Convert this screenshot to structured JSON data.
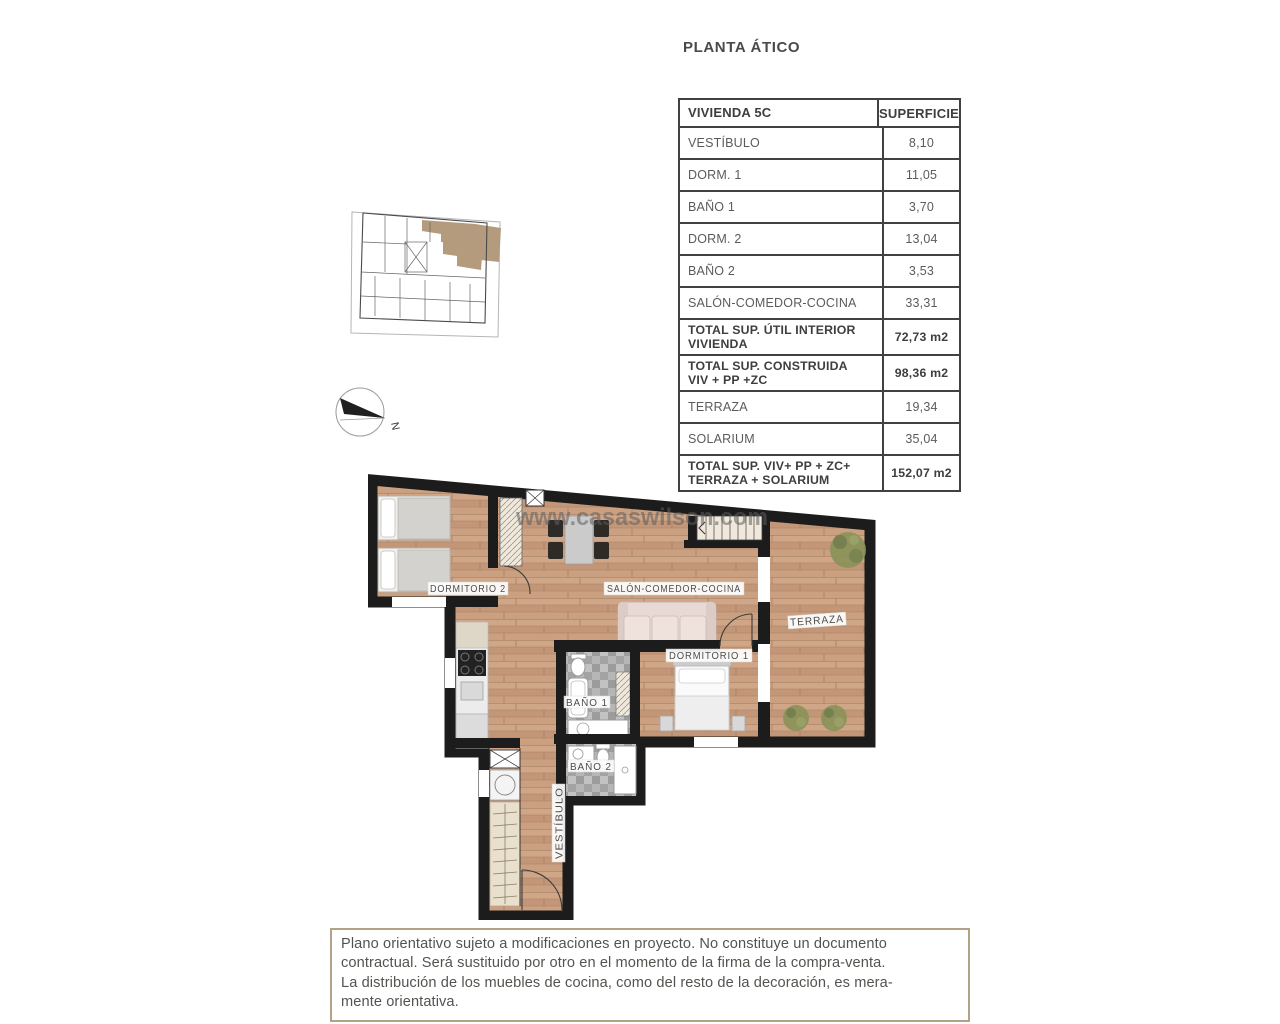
{
  "page": {
    "title": "PLANTA ÁTICO"
  },
  "area_table": {
    "header": {
      "name_col": "VIVIENDA 5C",
      "value_col": "SUPERFICIE"
    },
    "rows": [
      {
        "label": "VESTÍBULO",
        "value": "8,10"
      },
      {
        "label": "DORM. 1",
        "value": "11,05"
      },
      {
        "label": "BAÑO 1",
        "value": "3,70"
      },
      {
        "label": "DORM. 2",
        "value": "13,04"
      },
      {
        "label": "BAÑO 2",
        "value": "3,53"
      },
      {
        "label": "SALÓN-COMEDOR-COCINA",
        "value": "33,31"
      },
      {
        "label": "TOTAL SUP. ÚTIL INTERIOR\nVIVIENDA",
        "value": "72,73 m2"
      },
      {
        "label": "TOTAL SUP. CONSTRUIDA\nVIV + PP +ZC",
        "value": "98,36 m2"
      },
      {
        "label": "TERRAZA",
        "value": "19,34"
      },
      {
        "label": "SOLARIUM",
        "value": "35,04"
      },
      {
        "label": "TOTAL SUP. VIV+ PP + ZC+\nTERRAZA + SOLARIUM",
        "value": "152,07 m2"
      }
    ]
  },
  "floorplan": {
    "watermark": "www.casaswilson.com",
    "labels": {
      "dormitorio2": "DORMITORIO 2",
      "salon": "SALÓN-COMEDOR-COCINA",
      "dormitorio1": "DORMITORIO 1",
      "bano1": "BAÑO 1",
      "bano2": "BAÑO 2",
      "terraza": "TERRAZA",
      "vestibulo": "VESTÍBULO"
    }
  },
  "compass": {
    "north_label": "N"
  },
  "disclaimer": {
    "lines": [
      "Plano orientativo sujeto a modificaciones en proyecto. No constituye un documento",
      "contractual. Será sustituido por otro en el momento de la firma de la compra-venta.",
      "La distribución de los muebles de cocina, como del resto de la decoración, es mera-",
      "mente orientativa."
    ]
  },
  "colors": {
    "wall": "#1c1c1c",
    "wood_floor": "#c89e7f",
    "tile_floor": "#a9a9a9",
    "unit_highlight": "#b59b7d",
    "table_border": "#414141",
    "text_gray": "#58595b",
    "disclaimer_border": "#b3a386",
    "plant_green": "#8a9258"
  }
}
